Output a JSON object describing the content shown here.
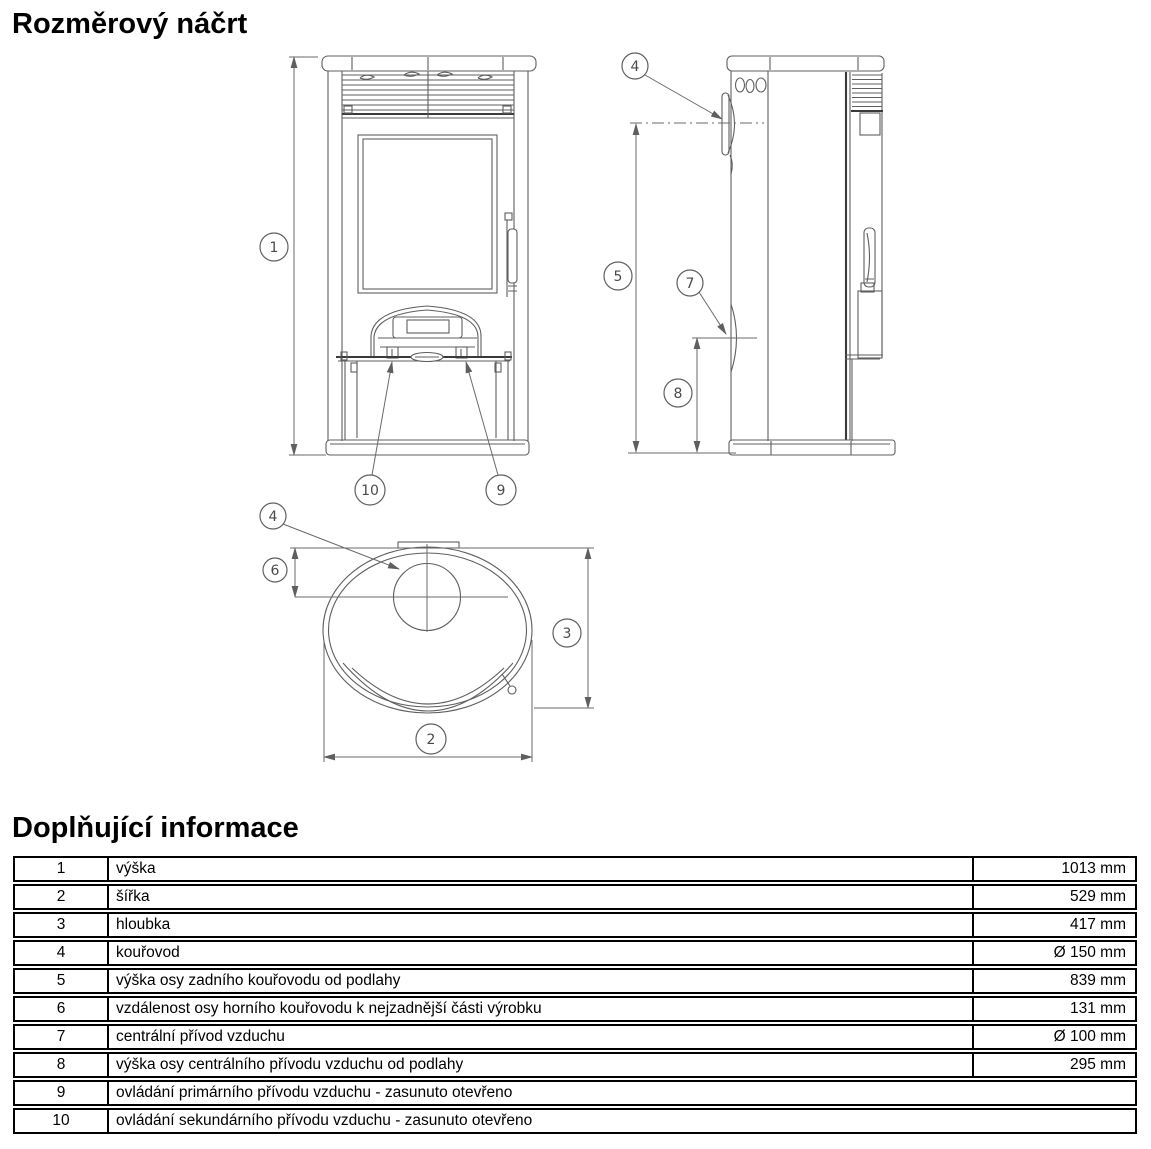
{
  "page": {
    "title": "Rozměrový náčrt",
    "section2_title": "Doplňující informace"
  },
  "diagram": {
    "line_color": "#5f5f5f",
    "callouts": {
      "c1": "1",
      "c2": "2",
      "c3": "3",
      "c4": "4",
      "c5": "5",
      "c6": "6",
      "c7": "7",
      "c8": "8",
      "c9": "9",
      "c10": "10"
    }
  },
  "info_table": {
    "rows": [
      {
        "num": "1",
        "label": "výška",
        "value": "1013 mm"
      },
      {
        "num": "2",
        "label": "šířka",
        "value": "529 mm"
      },
      {
        "num": "3",
        "label": "hloubka",
        "value": "417 mm"
      },
      {
        "num": "4",
        "label": "kouřovod",
        "value": "Ø 150 mm"
      },
      {
        "num": "5",
        "label": "výška osy zadního kouřovodu od podlahy",
        "value": "839 mm"
      },
      {
        "num": "6",
        "label": "vzdálenost osy horního kouřovodu k nejzadnější části výrobku",
        "value": "131 mm"
      },
      {
        "num": "7",
        "label": "centrální přívod vzduchu",
        "value": "Ø 100 mm"
      },
      {
        "num": "8",
        "label": "výška osy centrálního přívodu vzduchu od podlahy",
        "value": "295 mm"
      },
      {
        "num": "9",
        "label": "ovládání primárního přívodu vzduchu - zasunuto otevřeno",
        "value": ""
      },
      {
        "num": "10",
        "label": "ovládání sekundárního přívodu vzduchu - zasunuto otevřeno",
        "value": ""
      }
    ]
  }
}
